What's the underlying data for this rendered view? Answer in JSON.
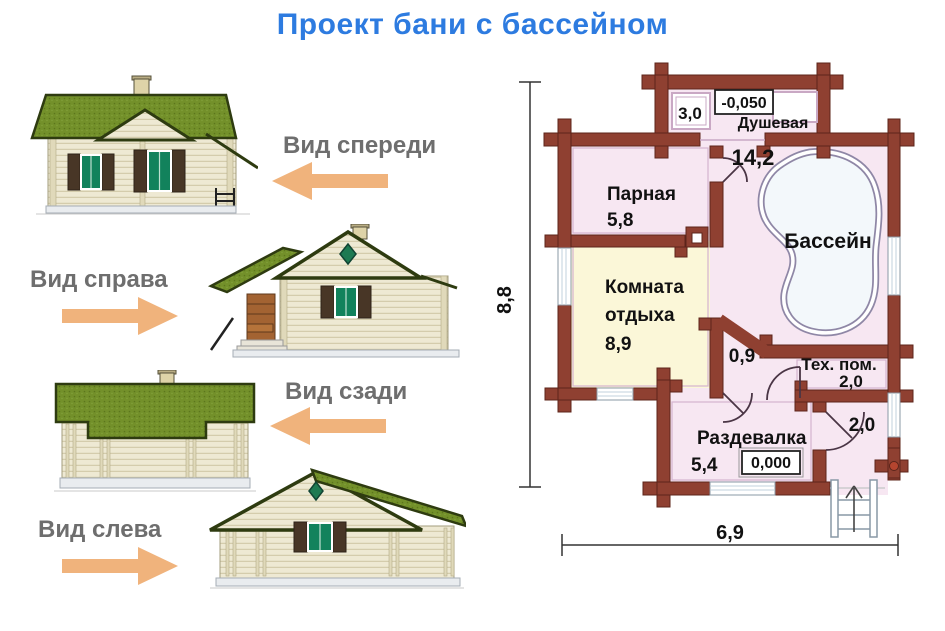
{
  "title": "Проект бани с бассейном",
  "views": {
    "front": {
      "label": "Вид спереди",
      "arrow_direction": "left"
    },
    "right": {
      "label": "Вид справа",
      "arrow_direction": "right"
    },
    "back": {
      "label": "Вид сзади",
      "arrow_direction": "left"
    },
    "left": {
      "label": "Вид слева",
      "arrow_direction": "right"
    }
  },
  "plan": {
    "shower": {
      "name": "Душевая",
      "area": "3,0",
      "level": "-0,050"
    },
    "steam": {
      "name": "Парная",
      "area": "5,8"
    },
    "pool_hall": {
      "area": "14,2",
      "pool_name": "Бассейн"
    },
    "lounge": {
      "name_line1": "Комната",
      "name_line2": "отдыха",
      "area": "8,9"
    },
    "corridor": {
      "area": "0,9"
    },
    "tech": {
      "name": "Тех. пом.",
      "area": "2,0"
    },
    "dressing": {
      "name": "Раздевалка",
      "area": "5,4",
      "level": "0,000"
    },
    "vestibule": {
      "area": "2,0"
    },
    "dimensions": {
      "width": "6,9",
      "height": "8,8"
    }
  },
  "colors": {
    "title": "#2d7be0",
    "arrow": "#f0b37c",
    "view_label": "#6e6e6e",
    "plan_wall": "#8f4031",
    "room_pink": "#f7e7f2",
    "room_yellow": "#fbf7d8",
    "pool_rim": "#8f87a6",
    "roof_green": "#73902a",
    "wall_cream": "#eee9d3",
    "window_glass": "#12825c"
  }
}
